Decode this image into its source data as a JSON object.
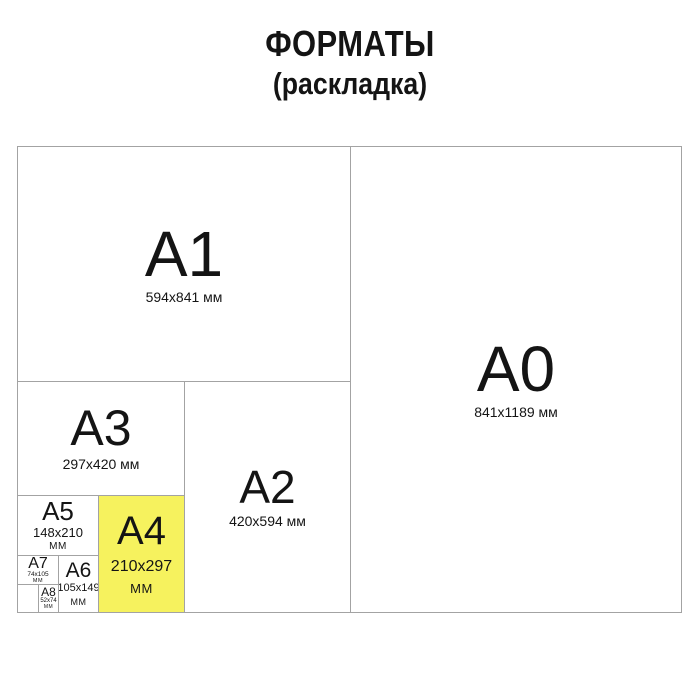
{
  "title": {
    "line1": "ФОРМАТЫ",
    "line2": "(раскладка)"
  },
  "colors": {
    "highlight_fill": "#F6F25E",
    "line": "#A3A3A3",
    "text": "#141414",
    "background": "#FFFFFF"
  },
  "formats": {
    "a0": {
      "label": "A0",
      "dims": "841x1189 мм"
    },
    "a1": {
      "label": "A1",
      "dims": "594x841 мм"
    },
    "a2": {
      "label": "A2",
      "dims": "420x594 мм"
    },
    "a3": {
      "label": "A3",
      "dims": "297x420 мм"
    },
    "a4": {
      "label": "A4",
      "dims": "210x297",
      "unit": "мм",
      "highlighted": true
    },
    "a5": {
      "label": "A5",
      "dims": "148x210",
      "unit": "мм"
    },
    "a6": {
      "label": "A6",
      "dims": "105x149",
      "unit": "мм"
    },
    "a7": {
      "label": "A7",
      "dims": "74x105",
      "unit": "мм"
    },
    "a8": {
      "label": "A8",
      "dims": "52x74",
      "unit": "мм"
    }
  }
}
